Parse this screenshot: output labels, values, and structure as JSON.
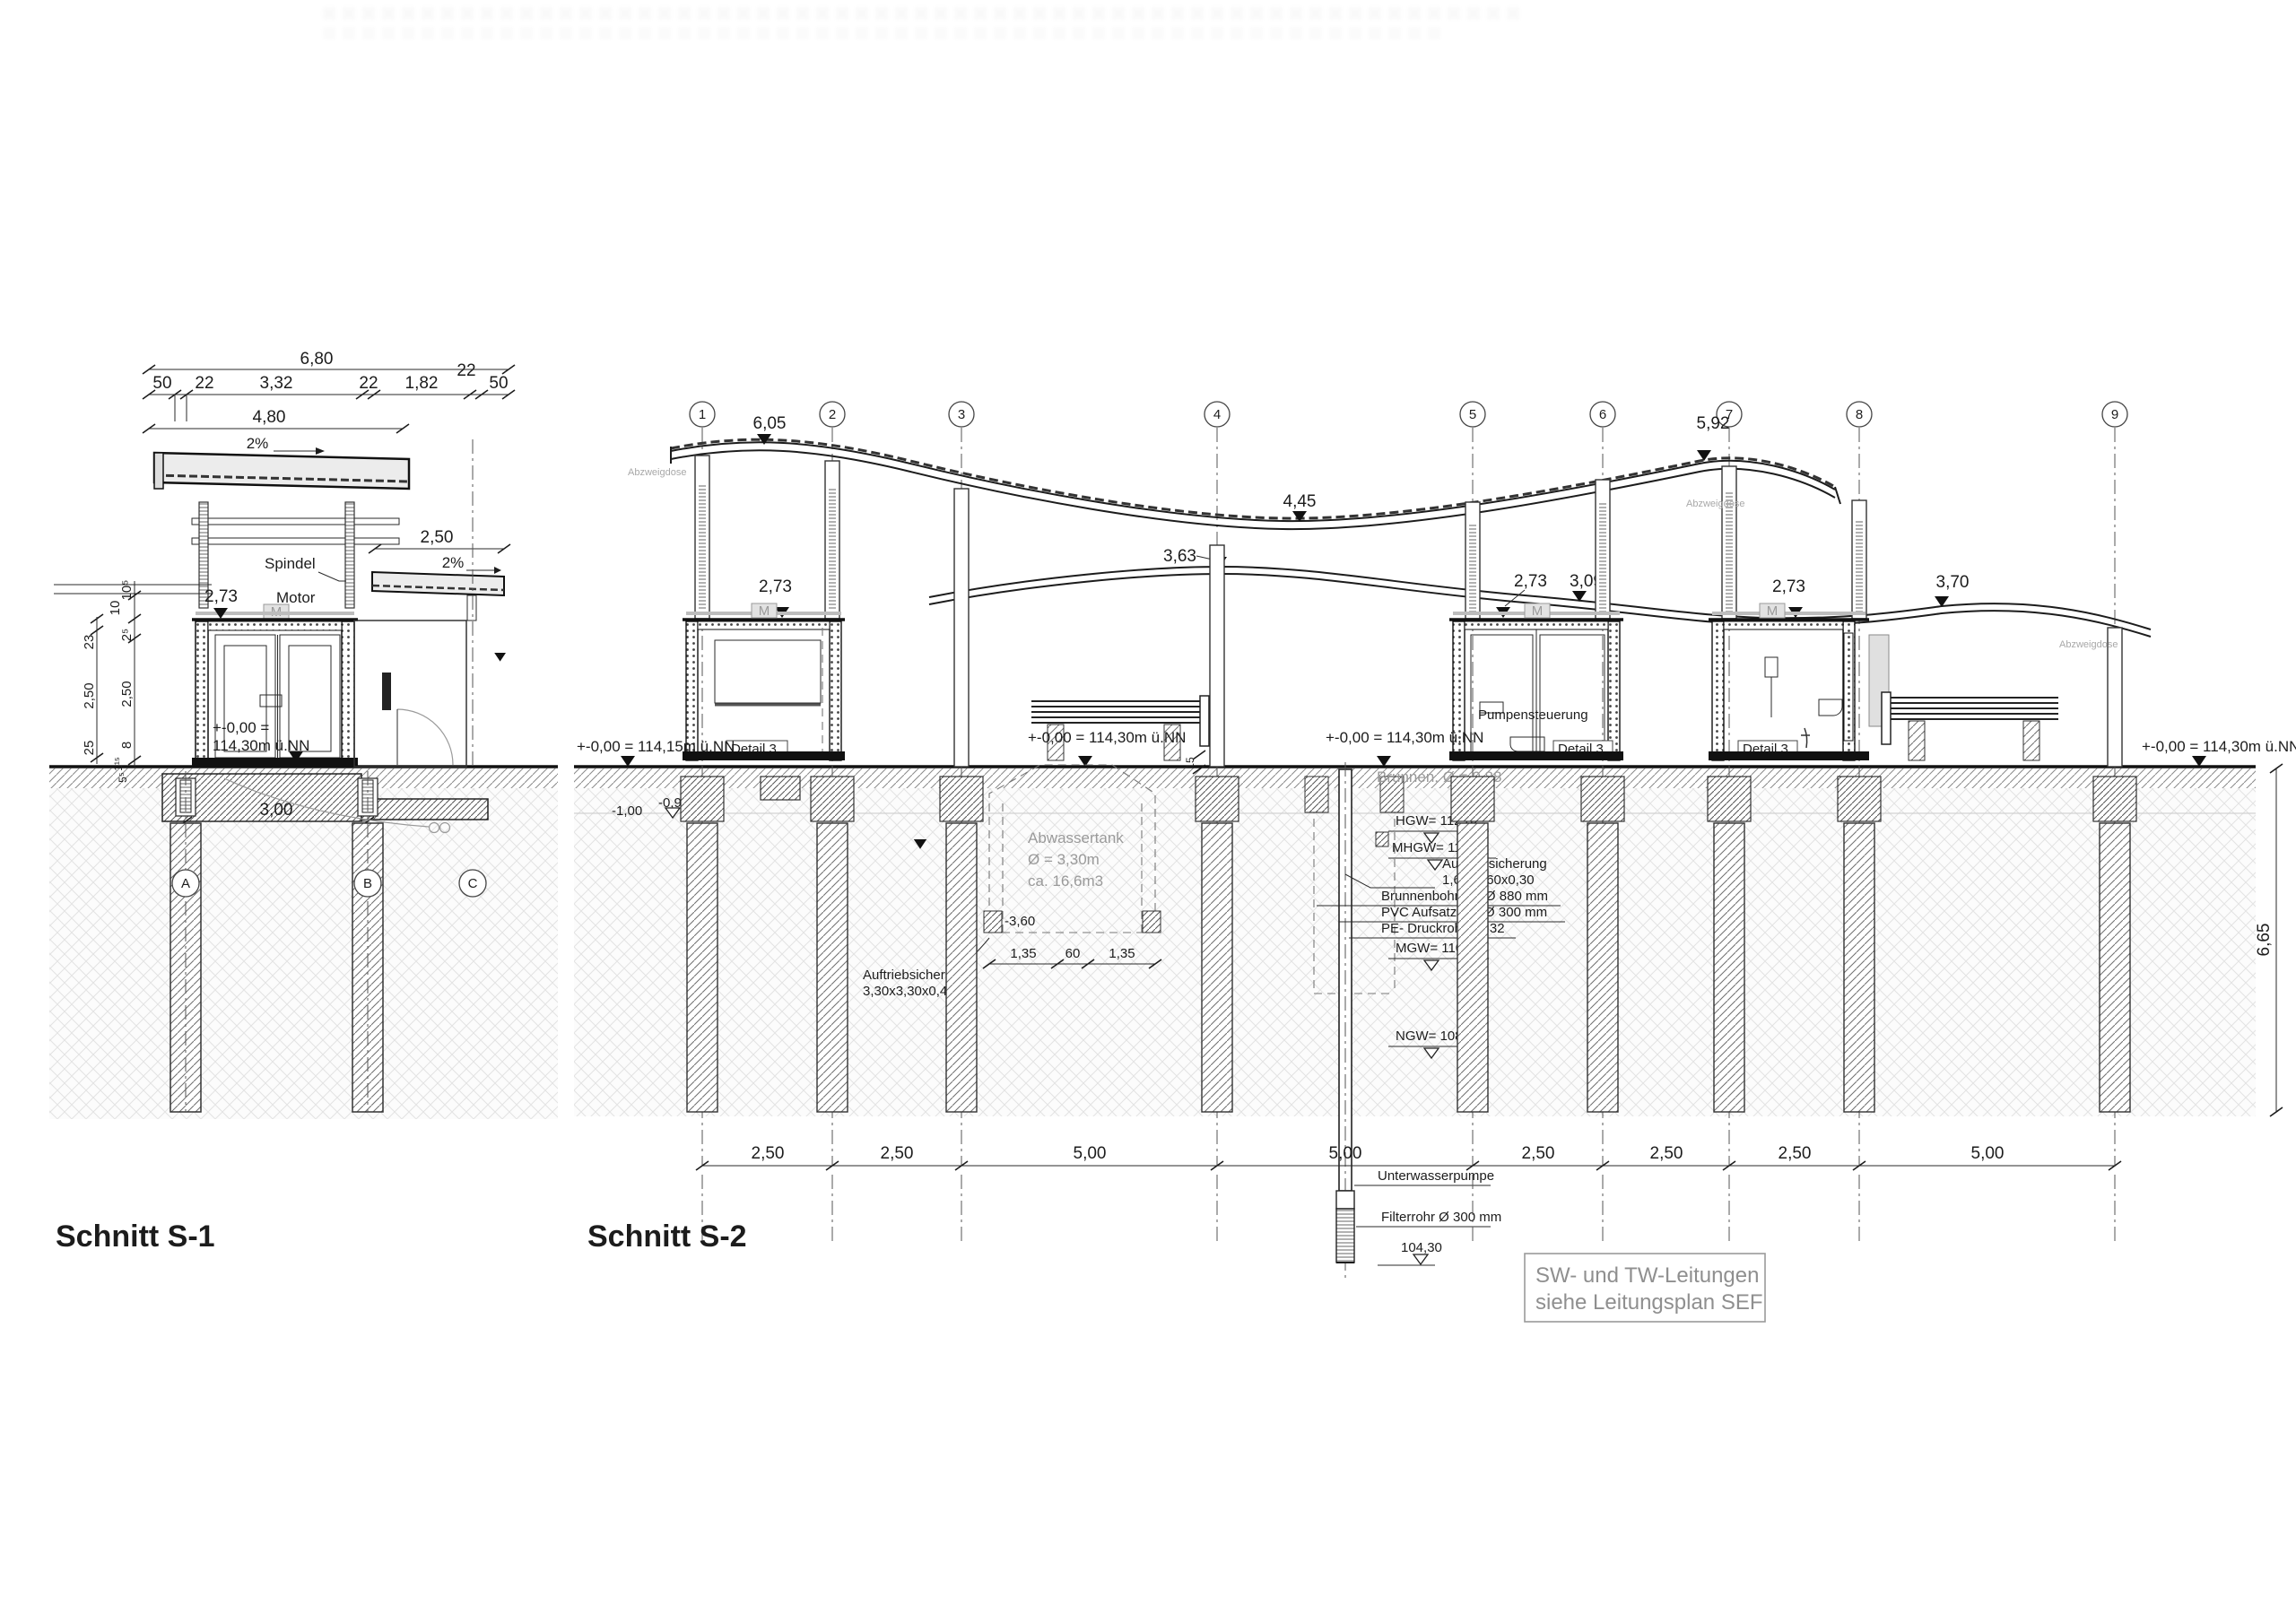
{
  "s1": {
    "title": "Schnitt S-1",
    "dim_680": "6,80",
    "dim_480": "4,80",
    "d50a": "50",
    "d22a": "22",
    "d332": "3,32",
    "d22b": "22",
    "d182": "1,82",
    "d22c": "22",
    "d50b": "50",
    "slope_main": "2%",
    "slope_canopy": "2%",
    "dim_250_canopy": "2,50",
    "spindel": "Spindel",
    "motor": "Motor",
    "m": "M",
    "lvl_273": "2,73",
    "zero1": "+-0,00 =",
    "zero2": "114,30m ü.NN",
    "dim_300": "3,00",
    "v23": "23",
    "v250a": "2,50",
    "v25": "25",
    "v105": "10⁵",
    "v10": "10",
    "v25s": "2⁵",
    "v250b": "2,50",
    "v8": "8",
    "v115": "1¹⁵",
    "v55": "5⁵",
    "gA": "A",
    "gB": "B",
    "gC": "C"
  },
  "s2": {
    "title": "Schnitt S-2",
    "grids": [
      "1",
      "2",
      "3",
      "4",
      "5",
      "6",
      "7",
      "8",
      "9"
    ],
    "lvl_605": "6,05",
    "lvl_592": "5,92",
    "lvl_445": "4,45",
    "lvl_363": "3,63",
    "lvl_370": "3,70",
    "lvl_273_b1": "2,73",
    "lvl_273_b2": "2,73",
    "lvl_309": "3,09",
    "lvl_273_b3": "2,73",
    "gl_left": "+-0,00 = 114,15m ü.NN",
    "gl_mid1": "+-0,00 = 114,30m ü.NN",
    "gl_mid2": "+-0,00 = 114,30m ü.NN",
    "gl_right": "+-0,00 = 114,30m ü.NN",
    "m100": "-1,00",
    "m090": "-0,90",
    "m360": "-3,60",
    "d15": "15",
    "tank1": "Abwassertank",
    "tank2": "Ø = 3,30m",
    "tank3": "ca. 16,6m3",
    "td135a": "1,35",
    "td60": "60",
    "td135b": "1,35",
    "auf1": "Auftriebsicherung",
    "auf1b": "3,30x3,30x0,40",
    "brunnen": "Brunnen, Ø = 0,88",
    "hgw": "HGW= 112,62",
    "mhgw": "MHGW= 112,19",
    "auf2": "Auftriebsicherung",
    "auf2b": "1,60x1,60x0,30",
    "bohrung": "Brunnenbohrung Ø 880 mm",
    "pvc": "PVC Aufsatzrohr Ø 300 mm",
    "pe": "PE- Druckrohr DN32",
    "mgw": "MGW= 110,41",
    "ngw": "NGW= 108,40",
    "pumpensteuerung": "Pumpensteuerung",
    "detail3": "Detail 3",
    "m": "M",
    "abzweigdose": "Abzweigdose",
    "uwpumpe": "Unterwasserpumpe",
    "filterrohr": "Filterrohr Ø 300 mm",
    "lvl_10430": "104,30",
    "bd": [
      "2,50",
      "2,50",
      "5,00",
      "5,00",
      "2,50",
      "2,50",
      "2,50",
      "5,00"
    ],
    "dim_665": "6,65"
  },
  "note": {
    "l1": "SW- und TW-Leitungen",
    "l2": "siehe Leitungsplan SEF"
  }
}
